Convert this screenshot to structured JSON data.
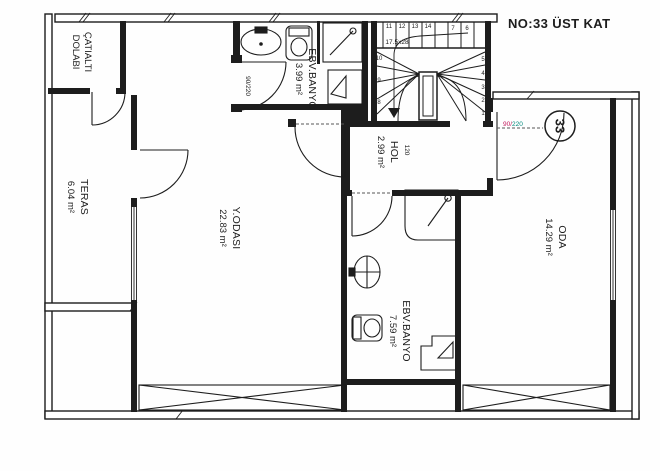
{
  "title": {
    "text": "NO:33 ÜST KAT",
    "color": "#e02b30"
  },
  "unit_badge": "33",
  "rooms": {
    "catialti_dolabi": {
      "name_line1": "ÇATIALTI",
      "name_line2": "DOLABI"
    },
    "teras": {
      "name": "TERAS",
      "area": "6.04 m²"
    },
    "ebv_banyo_ust": {
      "name": "EBV.BANYO",
      "area": "3.99 m²"
    },
    "hol": {
      "name": "HOL",
      "area": "2.99 m²"
    },
    "y_odasi": {
      "name": "Y.ODASI",
      "area": "22.83 m²"
    },
    "oda": {
      "name": "ODA",
      "area": "14.29 m²"
    },
    "ebv_banyo_alt": {
      "name": "EBV.BANYO",
      "area": "7.59 m²"
    }
  },
  "annotations": {
    "door_size_bath": "90/220",
    "door_size_oda_part1": "90/",
    "door_size_oda_part2": "220",
    "door_size_oda_color1": "#c2185b",
    "door_size_oda_color2": "#00897b",
    "hol_dim": "120",
    "tread_size": "17.5x28"
  },
  "stairs": {
    "treads": [
      "1",
      "2",
      "3",
      "4",
      "5",
      "6",
      "7",
      "8",
      "9",
      "10",
      "11",
      "12",
      "13",
      "14"
    ]
  }
}
